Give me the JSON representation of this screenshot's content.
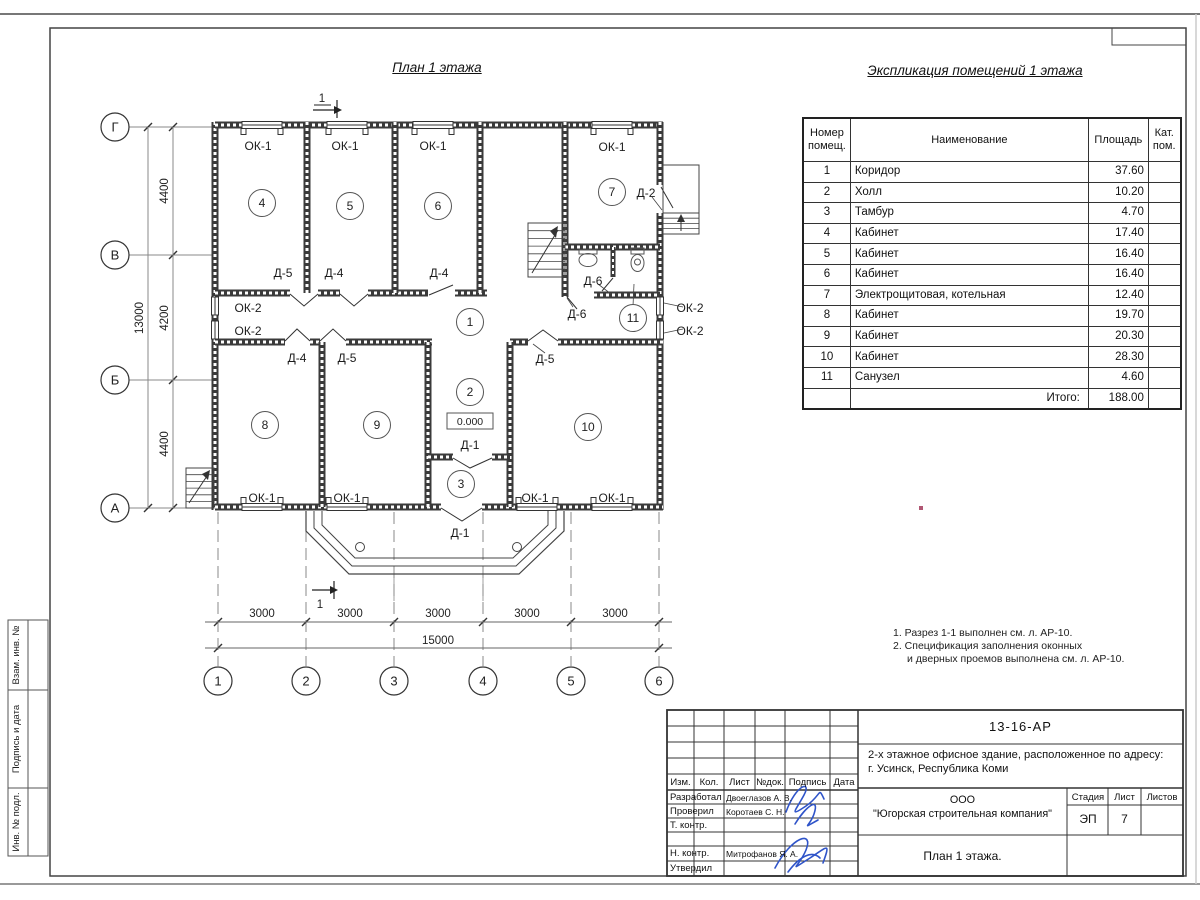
{
  "titles": {
    "plan": "План 1 этажа",
    "explication": "Экспликация помещений 1 этажа"
  },
  "explication_table": {
    "col_headers": [
      "Номер помещ.",
      "Наименование",
      "Площадь",
      "Кат. пом."
    ],
    "rows": [
      {
        "num": "1",
        "name": "Коридор",
        "area": "37.60"
      },
      {
        "num": "2",
        "name": "Холл",
        "area": "10.20"
      },
      {
        "num": "3",
        "name": "Тамбур",
        "area": "4.70"
      },
      {
        "num": "4",
        "name": "Кабинет",
        "area": "17.40"
      },
      {
        "num": "5",
        "name": "Кабинет",
        "area": "16.40"
      },
      {
        "num": "6",
        "name": "Кабинет",
        "area": "16.40"
      },
      {
        "num": "7",
        "name": "Электрощитовая, котельная",
        "area": "12.40"
      },
      {
        "num": "8",
        "name": "Кабинет",
        "area": "19.70"
      },
      {
        "num": "9",
        "name": "Кабинет",
        "area": "20.30"
      },
      {
        "num": "10",
        "name": "Кабинет",
        "area": "28.30"
      },
      {
        "num": "11",
        "name": "Санузел",
        "area": "4.60"
      }
    ],
    "total_label": "Итого:",
    "total_value": "188.00"
  },
  "notes": [
    "1. Разрез 1-1 выполнен см. л. АР-10.",
    "2. Спецификация заполнения оконных",
    "и дверных проемов выполнена см. л. АР-10."
  ],
  "plan": {
    "section": "1",
    "elevation": "0.000",
    "axis_letters": [
      {
        "label": "Г",
        "y": 127
      },
      {
        "label": "В",
        "y": 255
      },
      {
        "label": "Б",
        "y": 380
      },
      {
        "label": "А",
        "y": 508
      }
    ],
    "axis_numbers": [
      {
        "label": "1",
        "x": 218
      },
      {
        "label": "2",
        "x": 306
      },
      {
        "label": "3",
        "x": 394
      },
      {
        "label": "4",
        "x": 483
      },
      {
        "label": "5",
        "x": 571
      },
      {
        "label": "6",
        "x": 659
      }
    ],
    "v_dims": [
      {
        "label": "4400",
        "y": 191
      },
      {
        "label": "4200",
        "y": 318
      },
      {
        "label": "4400",
        "y": 444
      }
    ],
    "v_total": {
      "label": "13000",
      "y": 318
    },
    "h_dims": [
      {
        "label": "3000",
        "x": 262
      },
      {
        "label": "3000",
        "x": 350
      },
      {
        "label": "3000",
        "x": 438
      },
      {
        "label": "3000",
        "x": 527
      },
      {
        "label": "3000",
        "x": 615
      }
    ],
    "h_total": {
      "label": "15000",
      "x": 438
    },
    "rooms": [
      {
        "n": "1",
        "x": 470,
        "y": 322
      },
      {
        "n": "2",
        "x": 470,
        "y": 392
      },
      {
        "n": "3",
        "x": 461,
        "y": 484
      },
      {
        "n": "4",
        "x": 262,
        "y": 203
      },
      {
        "n": "5",
        "x": 350,
        "y": 206
      },
      {
        "n": "6",
        "x": 438,
        "y": 206
      },
      {
        "n": "7",
        "x": 612,
        "y": 192
      },
      {
        "n": "8",
        "x": 265,
        "y": 425
      },
      {
        "n": "9",
        "x": 377,
        "y": 425
      },
      {
        "n": "10",
        "x": 588,
        "y": 427
      },
      {
        "n": "11",
        "x": 633,
        "y": 318
      }
    ],
    "labels": [
      {
        "t": "ОК-1",
        "x": 258,
        "y": 150
      },
      {
        "t": "ОК-1",
        "x": 345,
        "y": 150
      },
      {
        "t": "ОК-1",
        "x": 433,
        "y": 150
      },
      {
        "t": "ОК-1",
        "x": 612,
        "y": 151
      },
      {
        "t": "ОК-1",
        "x": 262,
        "y": 502
      },
      {
        "t": "ОК-1",
        "x": 347,
        "y": 502
      },
      {
        "t": "ОК-1",
        "x": 535,
        "y": 502
      },
      {
        "t": "ОК-1",
        "x": 612,
        "y": 502
      },
      {
        "t": "ОК-2",
        "x": 248,
        "y": 312
      },
      {
        "t": "ОК-2",
        "x": 248,
        "y": 335
      },
      {
        "t": "ОК-2",
        "x": 690,
        "y": 312
      },
      {
        "t": "ОК-2",
        "x": 690,
        "y": 335
      },
      {
        "t": "Д-5",
        "x": 283,
        "y": 277
      },
      {
        "t": "Д-4",
        "x": 334,
        "y": 277
      },
      {
        "t": "Д-4",
        "x": 439,
        "y": 277
      },
      {
        "t": "Д-2",
        "x": 646,
        "y": 197
      },
      {
        "t": "Д-6",
        "x": 593,
        "y": 285
      },
      {
        "t": "Д-6",
        "x": 577,
        "y": 318
      },
      {
        "t": "Д-4",
        "x": 297,
        "y": 362
      },
      {
        "t": "Д-5",
        "x": 347,
        "y": 362
      },
      {
        "t": "Д-5",
        "x": 545,
        "y": 363
      },
      {
        "t": "Д-1",
        "x": 470,
        "y": 449
      },
      {
        "t": "Д-1",
        "x": 460,
        "y": 537
      }
    ]
  },
  "sidebar": {
    "labels": [
      "Взам. инв. №",
      "Подпись и дата",
      "Инв. № подл."
    ]
  },
  "title_block": {
    "doc_number": "13-16-АР",
    "project_line1": "2-х этажное офисное здание, расположенное по адресу:",
    "project_line2": "г. Усинск, Республика Коми",
    "company_line1": "ООО",
    "company_line2": "\"Югорская строительная компания\"",
    "sheet_title": "План 1 этажа.",
    "cols": [
      "Изм.",
      "Кол.",
      "Лист",
      "№док.",
      "Подпись",
      "Дата"
    ],
    "stage_label": "Стадия",
    "sheet_label": "Лист",
    "sheets_label": "Листов",
    "stage": "ЭП",
    "sheet_no": "7",
    "roles": [
      {
        "role": "Разработал",
        "name": "Двоеглазов А. В."
      },
      {
        "role": "Проверил",
        "name": "Коротаев С. Н."
      },
      {
        "role": "Т. контр.",
        "name": ""
      },
      {
        "role": "",
        "name": ""
      },
      {
        "role": "Н. контр.",
        "name": "Митрофанов Я. А."
      },
      {
        "role": "Утвердил",
        "name": ""
      }
    ]
  }
}
